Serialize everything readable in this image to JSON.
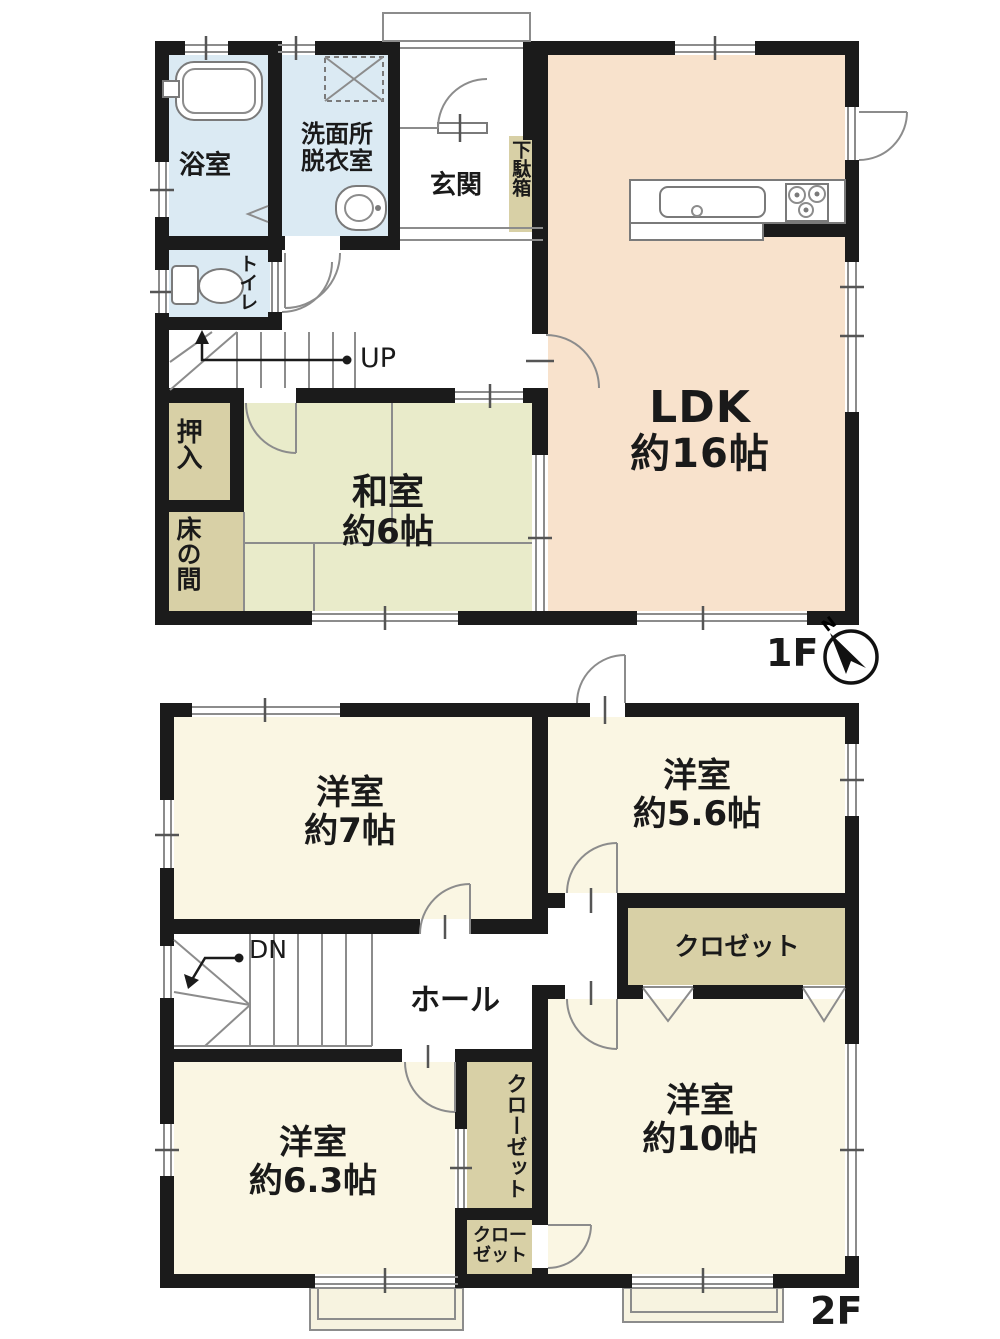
{
  "floor_1f": {
    "floor_label": "1F",
    "compass_north": "N",
    "bath": "浴室",
    "washroom_line1": "洗面所",
    "washroom_line2": "脱衣室",
    "entrance": "玄関",
    "shoe_cabinet": "下駄箱",
    "toilet": "トイレ",
    "stairs_direction": "UP",
    "closet_oshiire": "押入",
    "tokonoma": "床の間",
    "japanese_room_name": "和室",
    "japanese_room_size": "約6帖",
    "ldk_name": "LDK",
    "ldk_size": "約16帖"
  },
  "floor_2f": {
    "floor_label": "2F",
    "bedroom7_name": "洋室",
    "bedroom7_size": "約7帖",
    "bedroom56_name": "洋室",
    "bedroom56_size": "約5.6帖",
    "closet": "クロゼット",
    "stairs_direction": "DN",
    "hall": "ホール",
    "bedroom63_name": "洋室",
    "bedroom63_size": "約6.3帖",
    "closet_vertical": "クローゼット",
    "closet_small_line1": "クロー",
    "closet_small_line2": "ゼット",
    "bedroom10_name": "洋室",
    "bedroom10_size": "約10帖"
  },
  "colors": {
    "wall": "#1b1b1b",
    "ldk_floor": "#f8e2cc",
    "tatami_floor": "#e9ebca",
    "wet_area_floor": "#dbeaf3",
    "closet_floor": "#d8d0a6",
    "bedroom_floor": "#faf6e3"
  }
}
